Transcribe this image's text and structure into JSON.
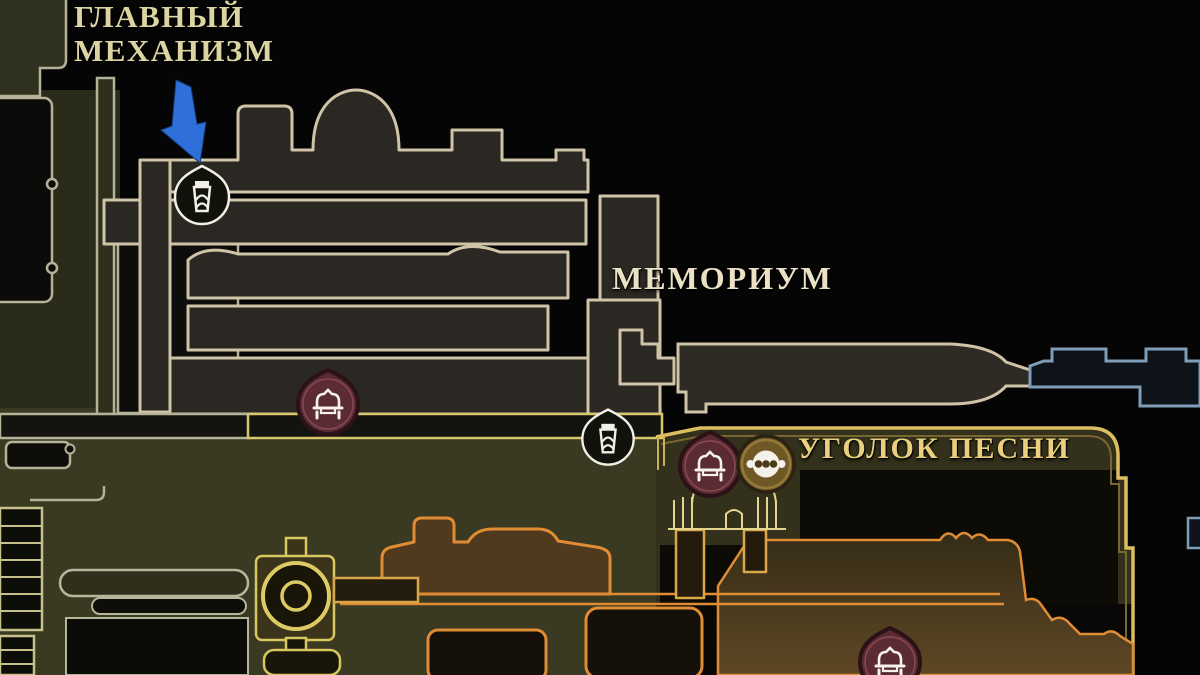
{
  "labels": {
    "main_mechanism": {
      "line1": "ГЛАВНЫЙ",
      "line2": "МЕХАНИЗМ"
    },
    "memorium": "МЕМОРИУМ",
    "song_corner": "УГОЛОК ПЕСНИ"
  },
  "markers": [
    {
      "name": "bellway-station-icon",
      "area": "main-mechanism",
      "pointed_by_arrow": true
    },
    {
      "name": "bench-icon",
      "area": "memorium"
    },
    {
      "name": "bellway-station-icon",
      "area": "memorium-lower"
    },
    {
      "name": "bench-icon",
      "area": "song-corner"
    },
    {
      "name": "bead-vendor-icon",
      "area": "song-corner"
    },
    {
      "name": "bench-icon",
      "area": "song-corner-lower"
    },
    {
      "name": "annotation-arrow",
      "area": "main-mechanism"
    }
  ],
  "colors": {
    "background": "#050505",
    "label_cream": "#ebe2c6",
    "label_pale": "#dcd5a2",
    "label_gold": "#e9cf7e",
    "outline_sage": "#b4b398",
    "outline_cream": "#d0c4a8",
    "outline_yellow": "#d6c66c",
    "outline_gold": "#dcbd61",
    "outline_orange": "#e08c34",
    "outline_blue": "#7e9db8",
    "arrow_blue": "#2e6fd9",
    "bench_red": "#5a2b33",
    "vendor_gold": "#6e5826",
    "icon_white": "#f2efe6"
  }
}
